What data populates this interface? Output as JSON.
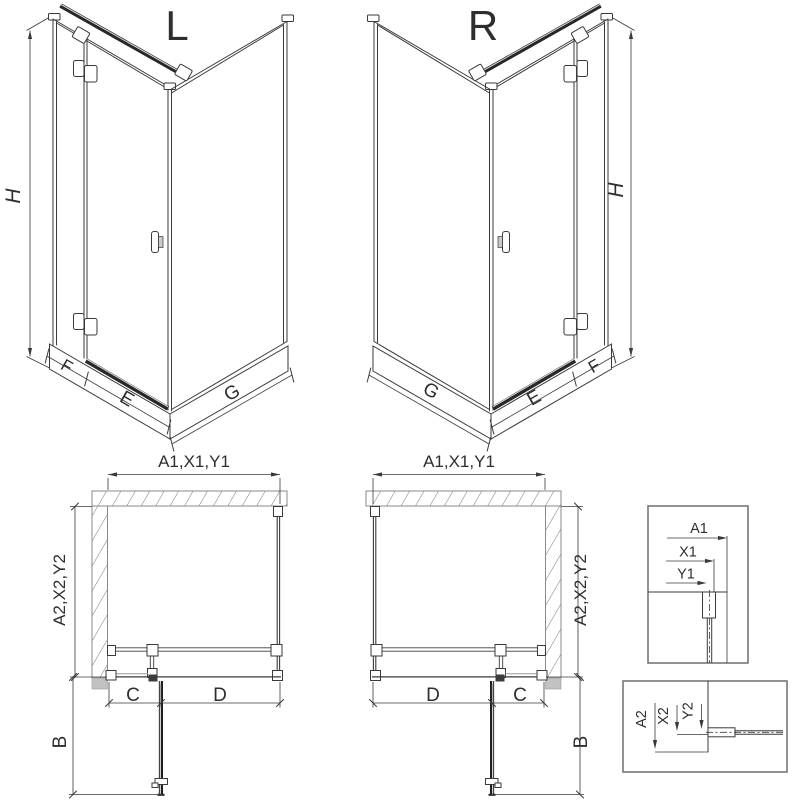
{
  "iso_views": {
    "left": {
      "variant_label": "L",
      "height_dim": "H",
      "fixed_panel_dim": "F",
      "door_dim": "E",
      "side_panel_dim": "G"
    },
    "right": {
      "variant_label": "R",
      "height_dim": "H",
      "fixed_panel_dim": "F",
      "door_dim": "E",
      "side_panel_dim": "G"
    }
  },
  "plan_views": {
    "left": {
      "width_dims_label": "A1,X1,Y1",
      "depth_dims_label": "A2,X2,Y2",
      "fixed_segment_dim": "C",
      "door_segment_dim": "D",
      "door_clearance_dim": "B"
    },
    "right": {
      "width_dims_label": "A1,X1,Y1",
      "depth_dims_label": "A2,X2,Y2",
      "fixed_segment_dim": "C",
      "door_segment_dim": "D",
      "door_clearance_dim": "B"
    }
  },
  "detail_views": {
    "width_detail": {
      "dims": [
        "A1",
        "X1",
        "Y1"
      ]
    },
    "depth_detail": {
      "dims": [
        "A2",
        "X2",
        "Y2"
      ]
    }
  },
  "colors": {
    "line": "#3a3a3a",
    "dark_bar": "#282828",
    "hatch": "#777777",
    "wall_outline": "#8a8a8a",
    "shadow": "#c2c2c2",
    "detail_border": "#777777",
    "background": "#ffffff"
  }
}
